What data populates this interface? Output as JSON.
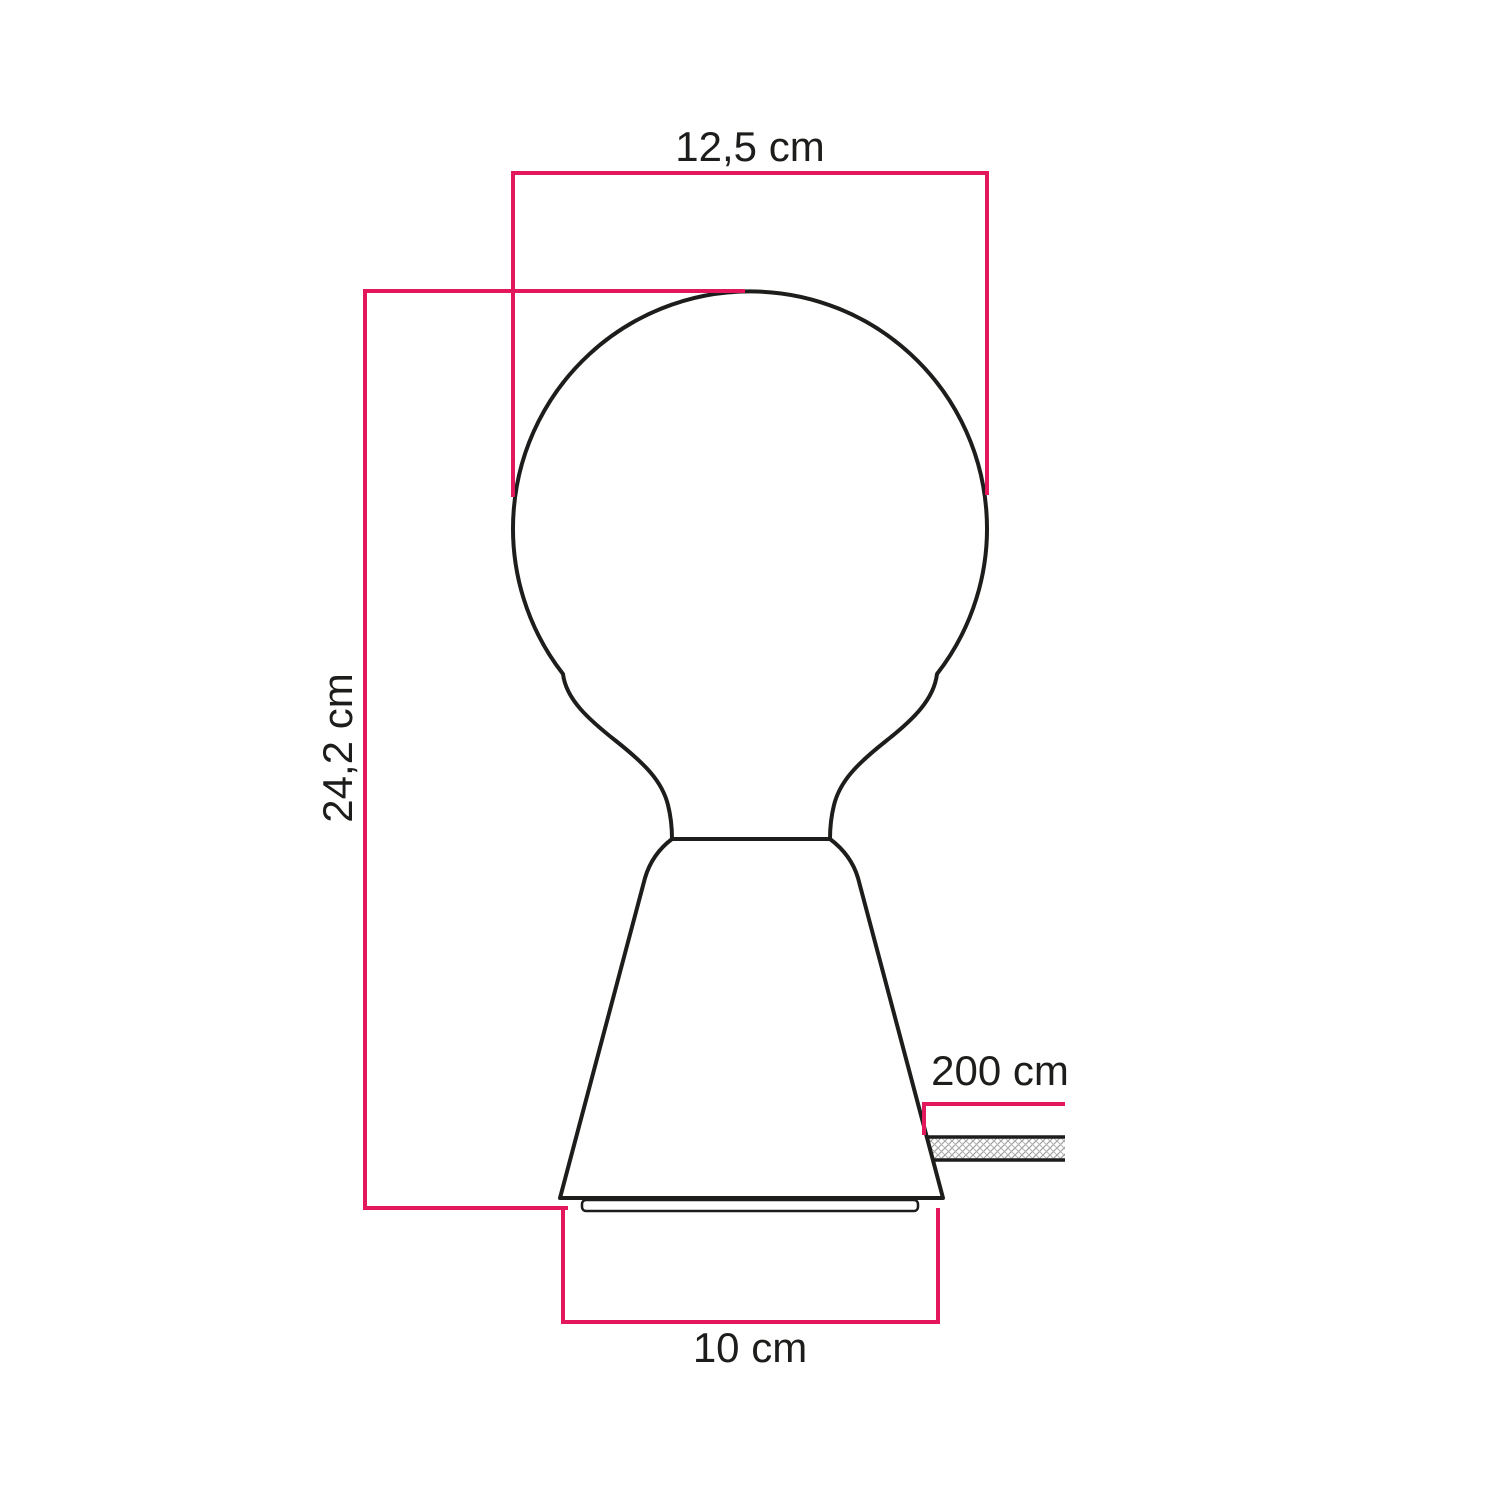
{
  "diagram": {
    "type": "product-dimension-drawing",
    "subject": "table lamp with globe bulb on conical base and fabric cable",
    "dimensions": {
      "bulb_diameter_label": "12,5 cm",
      "total_height_label": "24,2 cm",
      "cable_length_label": "200 cm",
      "base_diameter_label": "10 cm"
    },
    "colors": {
      "dimension_line": "#e3185c",
      "outline": "#1d1d1b",
      "hatch": "#9a9a9a",
      "background": "#ffffff"
    }
  }
}
